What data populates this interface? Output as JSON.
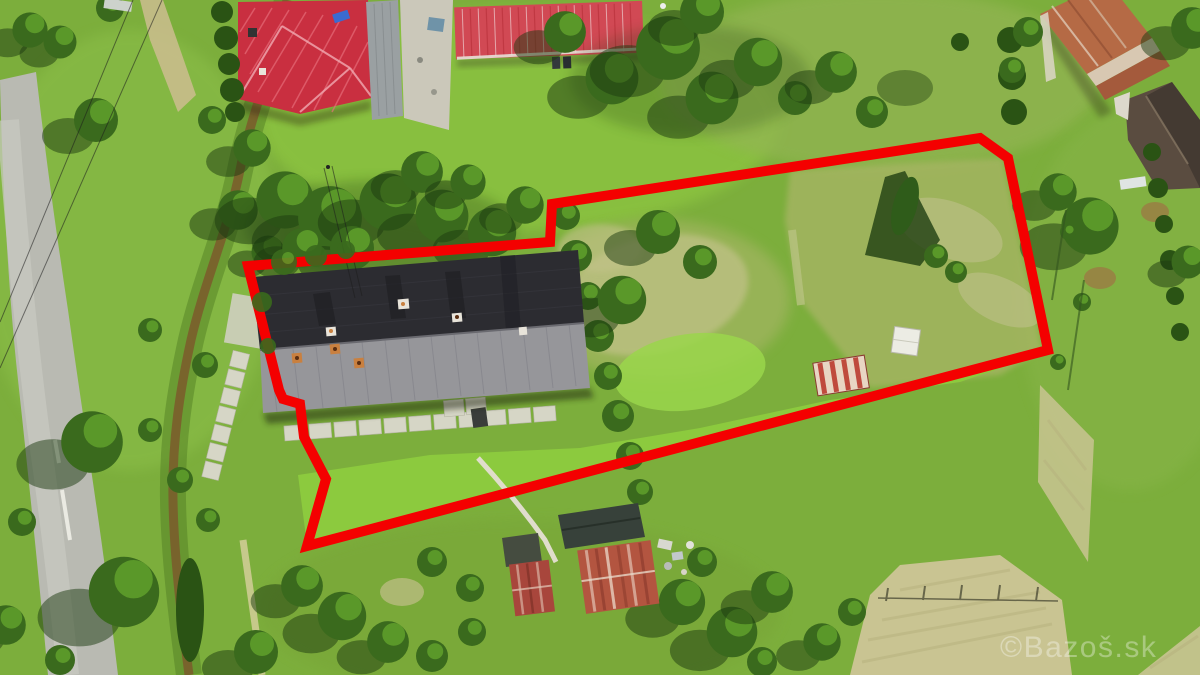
{
  "image": {
    "width": 1200,
    "height": 675,
    "kind": "aerial-drone-photograph",
    "description": "Aerial view of a rural property: a long dark-roofed house with garden plots, neighbouring red-roofed houses, a road on the left and fields; a thick red outline marks the advertised plot boundary."
  },
  "watermark": {
    "text": "©Bazoš.sk",
    "color": "#ffffff",
    "opacity": 0.34,
    "x": 1000,
    "y": 657,
    "font_size": 30
  },
  "boundary": {
    "color": "#f40000",
    "stroke_width": 10,
    "points": "248,266 550,242 552,204 980,138 1008,158 1048,350 307,546 326,479 304,437 300,404 283,399 279,390"
  },
  "palette": {
    "grass_base": "#7cae3c",
    "grass_light": "#8cbf4a",
    "lawn_top": "#8cc441",
    "lawn_bottom": "#8cca3e",
    "lawn_mow": "#9ad64b",
    "pasture": "#a9b566",
    "scrub_tan": "#c0c186",
    "field_tan": "#c9c492",
    "road_grey": "#b9bab2",
    "road_light": "#c9cac2",
    "concrete": "#d6d6c6",
    "creek_brown": "#7b5a2b",
    "roof_red_hip": "#c92f40",
    "roof_red_gable": "#d14954",
    "roof_dark_slope": "#2c2c31",
    "roof_grey_slope": "#96969a",
    "roof_rust_tile": "#b56a45",
    "roof_tile_band": "#d8c8b2",
    "roof_shingle": "#5a4c40",
    "annex_grey": "#9aa0a2",
    "yard_concrete": "#cbc8ba",
    "shed_rust": "#b35540",
    "shed_rust_small": "#a8463c",
    "shed_dark": "#454c40",
    "shed_white": "#ecece4",
    "stripe_red": "#bf4a3e",
    "stripe_white": "#e8d6c4"
  },
  "scene": {
    "elements": [
      {
        "name": "asphalt-road",
        "label": "country road, left side"
      },
      {
        "name": "creek-ditch",
        "label": "muddy drainage ditch"
      },
      {
        "name": "red-hip-roof-house",
        "label": "neighbour house with red hip roof, top left"
      },
      {
        "name": "red-gable-roof-house",
        "label": "neighbour outbuilding with bright red gable roof, top centre"
      },
      {
        "name": "rusty-tile-house",
        "label": "old house with rusted tile roof, top right"
      },
      {
        "name": "shingle-roof-building",
        "label": "dark shingle roof building, right edge"
      },
      {
        "name": "main-house",
        "label": "long house with dark and grey roof slopes inside boundary"
      },
      {
        "name": "concrete-slab-path",
        "label": "concrete slab walkways"
      },
      {
        "name": "rusty-sheds",
        "label": "rusted corrugated sheds, bottom centre"
      },
      {
        "name": "white-shed",
        "label": "small white-roof shed inside plot"
      },
      {
        "name": "striped-shed",
        "label": "red/white striped shed roof inside plot"
      },
      {
        "name": "property-boundary",
        "label": "red plot boundary outline"
      },
      {
        "name": "pasture-field",
        "label": "mowed hay field, bottom right"
      }
    ]
  }
}
